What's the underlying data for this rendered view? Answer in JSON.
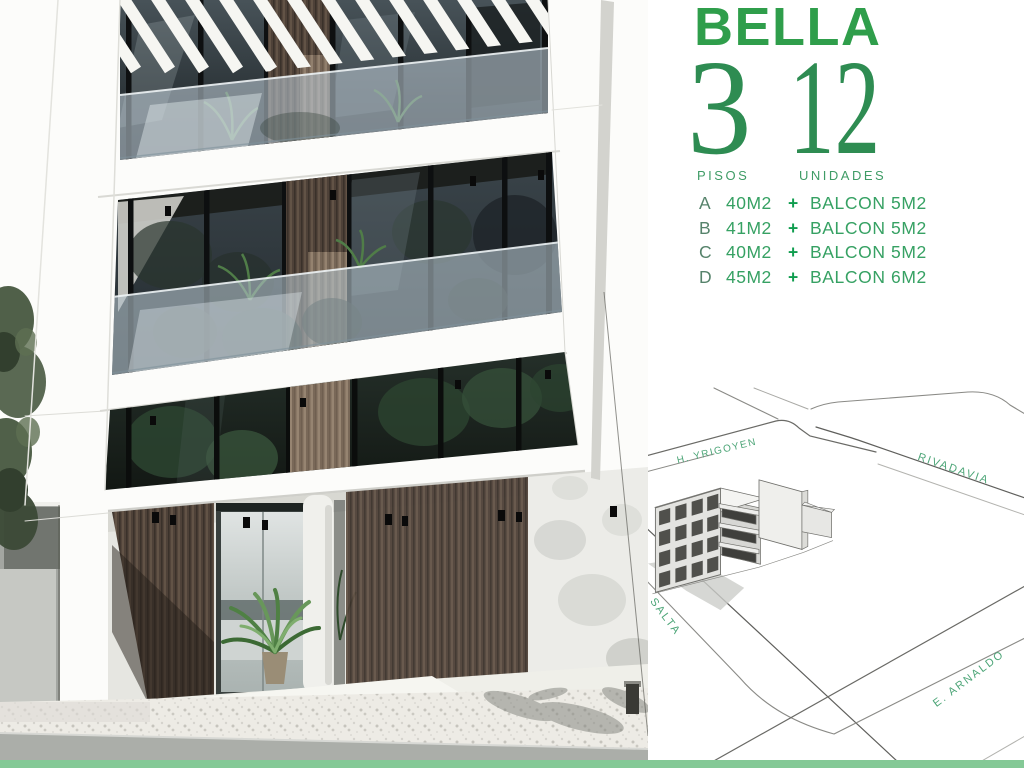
{
  "brand": {
    "name": "BELLA"
  },
  "stats": {
    "floors": {
      "value": "3",
      "label": "PISOS"
    },
    "units": {
      "value": "12",
      "label": "UNIDADES"
    }
  },
  "unit_list": [
    {
      "letter": "A",
      "size": "40M2",
      "plus": "+",
      "balcony": "BALCON 5M2"
    },
    {
      "letter": "B",
      "size": "41M2",
      "plus": "+",
      "balcony": "BALCON 5M2"
    },
    {
      "letter": "C",
      "size": "40M2",
      "plus": "+",
      "balcony": "BALCON 5M2"
    },
    {
      "letter": "D",
      "size": "45M2",
      "plus": "+",
      "balcony": "BALCON 6M2"
    }
  ],
  "map": {
    "streets": {
      "top": "H. YRIGOYEN",
      "right": "RIVADAVIA",
      "left": "SALTA",
      "bottom": "E. ARNALDO"
    }
  },
  "colors": {
    "brand_green": "#2F9E4B",
    "number_green": "#2E8C52",
    "label_green": "#3F9C66",
    "unit_letter": "#56836B",
    "unit_value": "#36A163",
    "plus_green": "#0F9D4E",
    "street_label": "#4CA577",
    "footer_bar": "#84C996"
  }
}
